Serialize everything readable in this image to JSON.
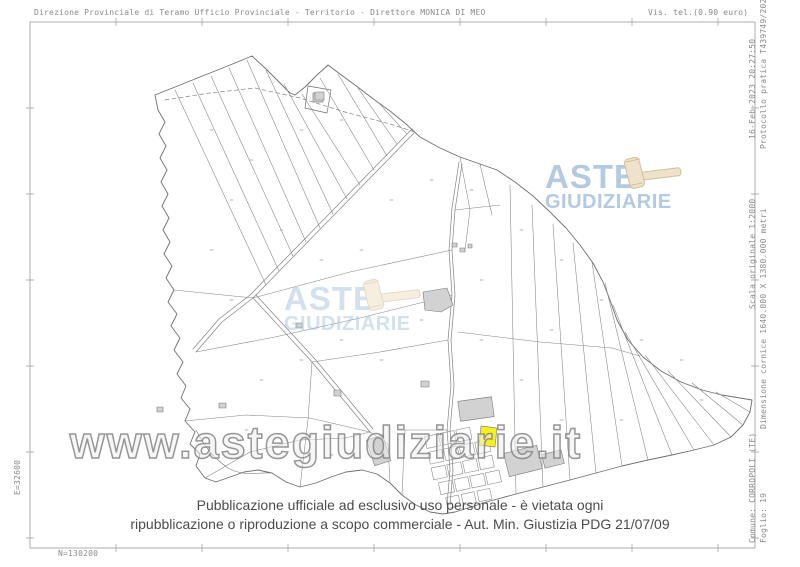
{
  "header": {
    "left": "Direzione Provinciale di Teramo  Ufficio Provinciale - Territorio - Direttore MONICA DI MEO",
    "right": "Vis. tel.(0.90 euro)"
  },
  "margins": {
    "right_top_line1": "16-Feb-2023 20:27:50",
    "right_top_line2": "Protocollo pratica T439749/2023",
    "right_middle_line1": "Scala originale 1:2000",
    "right_middle_line2": "Dimensione cornice 1640.000 X 1380.000 metri",
    "right_bottom_line1": "Comune: CORROPOLI (TE)",
    "right_bottom_line2": "Foglio: 19",
    "left_coordinate": "E=32600",
    "bottom_coordinate": "N=130200"
  },
  "watermark": {
    "text": "www.astegiudiziarie.it"
  },
  "logo": {
    "line1": "ASTE",
    "line2": "GIUDIZIARIE",
    "text_color": "#a9c3dd",
    "gavel_fill": "#ecdfc4",
    "gavel_stroke": "#cdb78f"
  },
  "footer": {
    "line1": "Pubblicazione ufficiale ad esclusivo uso personale - è vietata ogni",
    "line2": "ripubblicazione o riproduzione a scopo commerciale - Aut. Min. Giustizia PDG 21/07/09"
  },
  "colors": {
    "map_line": "#828282",
    "building_fill": "#d2d2d2",
    "highlight": "#f8ee1e",
    "frame": "#9a9a9a"
  }
}
